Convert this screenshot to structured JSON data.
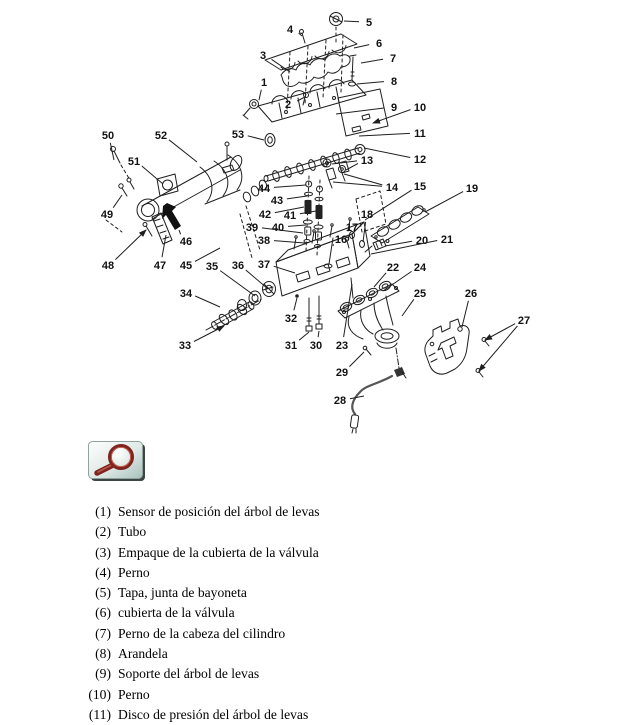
{
  "page": {
    "background": "#ffffff",
    "ink": "#1f1f1f",
    "width": 619,
    "height": 720
  },
  "diagram": {
    "title": "exploded-view-cylinder-head-assembly",
    "ink": "#1f1f1f",
    "callouts": [
      {
        "n": "1",
        "x": 264,
        "y": 82,
        "t": [
          [
            259,
            100
          ]
        ]
      },
      {
        "n": "2",
        "x": 288,
        "y": 104,
        "t": [
          [
            305,
            97
          ]
        ]
      },
      {
        "n": "3",
        "x": 263,
        "y": 55,
        "t": [
          [
            290,
            72
          ]
        ]
      },
      {
        "n": "4",
        "x": 290,
        "y": 29,
        "t": [
          [
            302,
            36
          ]
        ]
      },
      {
        "n": "5",
        "x": 369,
        "y": 22,
        "t": [
          [
            344,
            21
          ]
        ]
      },
      {
        "n": "6",
        "x": 379,
        "y": 43,
        "t": [
          [
            354,
            48
          ]
        ]
      },
      {
        "n": "7",
        "x": 393,
        "y": 58,
        "t": [
          [
            361,
            63
          ]
        ]
      },
      {
        "n": "8",
        "x": 394,
        "y": 81,
        "t": [
          [
            357,
            84
          ]
        ]
      },
      {
        "n": "9",
        "x": 394,
        "y": 107,
        "t": [
          [
            336,
            114
          ]
        ]
      },
      {
        "n": "10",
        "x": 420,
        "y": 107,
        "t": [
          [
            373,
            123
          ]
        ],
        "a": true
      },
      {
        "n": "11",
        "x": 420,
        "y": 133,
        "t": [
          [
            359,
            136
          ]
        ]
      },
      {
        "n": "12",
        "x": 420,
        "y": 159,
        "t": [
          [
            364,
            148
          ]
        ]
      },
      {
        "n": "13",
        "x": 367,
        "y": 160,
        "t": [
          [
            332,
            164
          ],
          [
            346,
            170
          ]
        ]
      },
      {
        "n": "14",
        "x": 392,
        "y": 187,
        "t": [
          [
            344,
            174
          ],
          [
            333,
            182
          ]
        ]
      },
      {
        "n": "15",
        "x": 420,
        "y": 186,
        "t": [
          [
            365,
            220
          ]
        ]
      },
      {
        "n": "16",
        "x": 341,
        "y": 239,
        "t": [
          [
            333,
            246
          ]
        ]
      },
      {
        "n": "17",
        "x": 352,
        "y": 227,
        "t": [
          [
            348,
            240
          ]
        ]
      },
      {
        "n": "18",
        "x": 367,
        "y": 214,
        "t": [
          [
            363,
            242
          ]
        ]
      },
      {
        "n": "19",
        "x": 472,
        "y": 188,
        "t": [
          [
            425,
            212
          ]
        ]
      },
      {
        "n": "20",
        "x": 422,
        "y": 240,
        "t": [
          [
            385,
            246
          ]
        ]
      },
      {
        "n": "21",
        "x": 447,
        "y": 239,
        "t": [
          [
            371,
            254
          ]
        ]
      },
      {
        "n": "22",
        "x": 393,
        "y": 267,
        "t": [
          [
            374,
            287
          ]
        ]
      },
      {
        "n": "23",
        "x": 342,
        "y": 345,
        "t": [
          [
            352,
            284
          ]
        ]
      },
      {
        "n": "24",
        "x": 420,
        "y": 267,
        "t": [
          [
            383,
            291
          ]
        ]
      },
      {
        "n": "25",
        "x": 420,
        "y": 293,
        "t": [
          [
            402,
            316
          ]
        ]
      },
      {
        "n": "26",
        "x": 471,
        "y": 293,
        "t": [
          [
            462,
            327
          ]
        ]
      },
      {
        "n": "27",
        "x": 524,
        "y": 320,
        "t": [
          [
            485,
            340
          ],
          [
            479,
            371
          ]
        ],
        "a": true
      },
      {
        "n": "28",
        "x": 340,
        "y": 400,
        "t": [
          [
            364,
            396
          ]
        ]
      },
      {
        "n": "29",
        "x": 342,
        "y": 372,
        "t": [
          [
            364,
            352
          ]
        ]
      },
      {
        "n": "30",
        "x": 316,
        "y": 345,
        "t": [
          [
            319,
            331
          ]
        ]
      },
      {
        "n": "31",
        "x": 291,
        "y": 345,
        "t": [
          [
            309,
            332
          ]
        ]
      },
      {
        "n": "32",
        "x": 291,
        "y": 318,
        "t": [
          [
            297,
            298
          ]
        ]
      },
      {
        "n": "33",
        "x": 185,
        "y": 345,
        "t": [
          [
            224,
            326
          ]
        ],
        "a": true
      },
      {
        "n": "34",
        "x": 186,
        "y": 293,
        "t": [
          [
            220,
            307
          ]
        ]
      },
      {
        "n": "35",
        "x": 212,
        "y": 266,
        "t": [
          [
            255,
            296
          ]
        ]
      },
      {
        "n": "36",
        "x": 238,
        "y": 265,
        "t": [
          [
            268,
            289
          ]
        ]
      },
      {
        "n": "37",
        "x": 264,
        "y": 264,
        "t": [
          [
            295,
            273
          ]
        ]
      },
      {
        "n": "38",
        "x": 264,
        "y": 240,
        "t": [
          [
            305,
            243
          ]
        ]
      },
      {
        "n": "39",
        "x": 252,
        "y": 227,
        "t": [
          [
            303,
            233
          ]
        ]
      },
      {
        "n": "40",
        "x": 278,
        "y": 227,
        "t": [
          [
            306,
            225
          ]
        ]
      },
      {
        "n": "41",
        "x": 290,
        "y": 215,
        "t": [
          [
            316,
            211
          ]
        ]
      },
      {
        "n": "42",
        "x": 265,
        "y": 214,
        "t": [
          [
            304,
            207
          ]
        ]
      },
      {
        "n": "43",
        "x": 277,
        "y": 200,
        "t": [
          [
            307,
            196
          ]
        ]
      },
      {
        "n": "44",
        "x": 264,
        "y": 188,
        "t": [
          [
            306,
            185
          ]
        ]
      },
      {
        "n": "45",
        "x": 186,
        "y": 265,
        "t": [
          [
            220,
            248
          ]
        ]
      },
      {
        "n": "46",
        "x": 186,
        "y": 241,
        "t": [
          [
            179,
            230
          ]
        ]
      },
      {
        "n": "47",
        "x": 160,
        "y": 265,
        "t": [
          [
            166,
            235
          ]
        ]
      },
      {
        "n": "48",
        "x": 108,
        "y": 265,
        "t": [
          [
            146,
            230
          ]
        ],
        "a": true
      },
      {
        "n": "49",
        "x": 107,
        "y": 214,
        "t": [
          [
            122,
            195
          ]
        ]
      },
      {
        "n": "50",
        "x": 108,
        "y": 135,
        "t": [
          [
            114,
            160
          ]
        ]
      },
      {
        "n": "51",
        "x": 134,
        "y": 161,
        "t": [
          [
            163,
            184
          ]
        ]
      },
      {
        "n": "52",
        "x": 161,
        "y": 135,
        "t": [
          [
            197,
            162
          ]
        ]
      },
      {
        "n": "53",
        "x": 238,
        "y": 134,
        "t": [
          [
            264,
            140
          ]
        ]
      }
    ]
  },
  "zoom_button": {
    "icon": "magnifier-icon",
    "glass_ring_color": "#7e241d",
    "face_from": "#ffffff",
    "face_to": "#a9c1bb",
    "shadow_color": "#3c4543"
  },
  "parts_list": {
    "items": [
      {
        "num": "(1)",
        "label": "Sensor de posición del árbol de levas"
      },
      {
        "num": "(2)",
        "label": "Tubo"
      },
      {
        "num": "(3)",
        "label": "Empaque de la cubierta de la válvula"
      },
      {
        "num": "(4)",
        "label": "Perno"
      },
      {
        "num": "(5)",
        "label": "Tapa, junta de bayoneta"
      },
      {
        "num": "(6)",
        "label": "cubierta de la válvula"
      },
      {
        "num": "(7)",
        "label": "Perno de la cabeza del cilindro"
      },
      {
        "num": "(8)",
        "label": "Arandela"
      },
      {
        "num": "(9)",
        "label": "Soporte del árbol de levas"
      },
      {
        "num": "(10)",
        "label": "Perno"
      },
      {
        "num": "(11)",
        "label": "Disco de presión del árbol de levas"
      }
    ]
  }
}
